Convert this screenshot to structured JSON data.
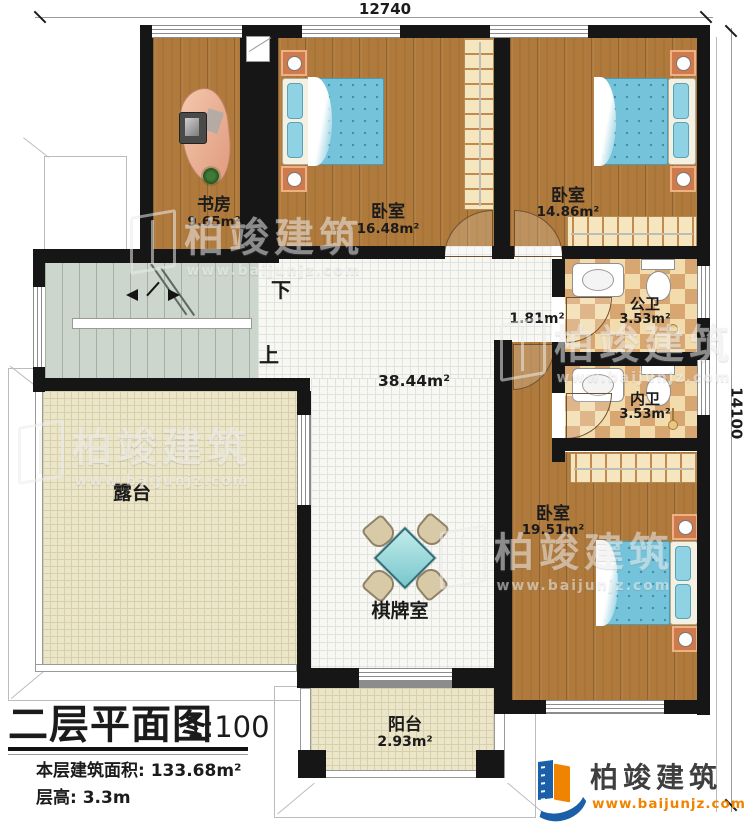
{
  "title_block": {
    "title": "二层平面图",
    "scale": "1:100",
    "floor_area": "本层建筑面积: 133.68m²",
    "floor_height": "层高: 3.3m"
  },
  "dimensions": {
    "top": "12740",
    "right": "14100"
  },
  "rooms": [
    {
      "id": "study",
      "name": "书房",
      "area": "9.65m²"
    },
    {
      "id": "bedroom1",
      "name": "卧室",
      "area": "16.48m²"
    },
    {
      "id": "bedroom2",
      "name": "卧室",
      "area": "14.86m²"
    },
    {
      "id": "public-bath",
      "name": "公卫",
      "area": "3.53m²"
    },
    {
      "id": "ensuite-bath",
      "name": "内卫",
      "area": "3.53m²"
    },
    {
      "id": "bedroom3",
      "name": "卧室",
      "area": "19.51m²"
    },
    {
      "id": "chess-room",
      "name": "棋牌室",
      "area": ""
    },
    {
      "id": "terrace",
      "name": "露台",
      "area": ""
    },
    {
      "id": "balcony",
      "name": "阳台",
      "area": "2.93m²"
    }
  ],
  "hall": {
    "area_main": "38.44m²",
    "area_small": "1.81m²"
  },
  "stairs": {
    "down": "下",
    "up": "上"
  },
  "brand": {
    "name": "柏竣建筑",
    "url": "www.baijunjz.com"
  },
  "colors": {
    "wall": "#161616",
    "wood": "#b07a3c",
    "tile_checker_dark": "#d7a671",
    "bed_blue": "#74c3da",
    "terrace": "#ebe5c9",
    "logo_blue": "#1a5fa8",
    "logo_orange": "#f08300"
  }
}
